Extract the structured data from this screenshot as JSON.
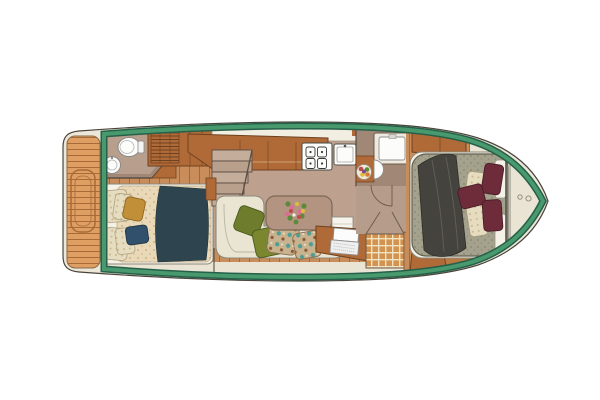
{
  "scene": {
    "subject": "motor-yacht interior floor plan",
    "view": "top-down",
    "rooms": [
      {
        "name": "aft-deck",
        "features": [
          "teak-planking",
          "deck-hatch"
        ]
      },
      {
        "name": "aft-head",
        "features": [
          "toilet",
          "round-sink",
          "corner-counter"
        ]
      },
      {
        "name": "wardrobe",
        "features": [
          "louvered-doors"
        ]
      },
      {
        "name": "aft-cabin",
        "features": [
          "double-bed",
          "cream-duvet",
          "teal-throw",
          "gold-pillow",
          "navy-pillow"
        ]
      },
      {
        "name": "saloon",
        "features": [
          "l-shaped-sofa",
          "olive-pillows",
          "floral-pillows",
          "coffee-table",
          "flower-bouquet",
          "magazine"
        ]
      },
      {
        "name": "galley",
        "features": [
          "counter",
          "cooktop-4-burners",
          "sink"
        ]
      },
      {
        "name": "companionway",
        "features": [
          "stairs"
        ]
      },
      {
        "name": "nav-desk",
        "features": [
          "desk",
          "open-laptop"
        ]
      },
      {
        "name": "forward-head",
        "features": [
          "square-sink",
          "half-round-basin",
          "fruit-bowl",
          "door-swing"
        ]
      },
      {
        "name": "shower",
        "features": [
          "teak-grating"
        ]
      },
      {
        "name": "forward-cabin",
        "features": [
          "island-double-bed",
          "sage-quilt",
          "charcoal-throw",
          "burgundy-pillows",
          "cream-pillows",
          "headboard-shelves"
        ]
      },
      {
        "name": "bow-deck",
        "features": [
          "deck-fittings"
        ]
      }
    ]
  },
  "palette": {
    "bg": "#ffffff",
    "line_dark": "#4a453c",
    "deck_cream": "#ece7d8",
    "interior_cream": "#e9e4d4",
    "green_band": "#49996f",
    "green_band_dark": "#266049",
    "teak_base": "#df9f63",
    "teak_seam": "#a86b38",
    "floor_base": "#c88d5a",
    "floor_seam": "#a2693a",
    "carpet": "#bda08e",
    "wall_taupe": "#a18876",
    "wall_floor": "#b59c8b",
    "wood_cabinet": "#b06a38",
    "wood_dark": "#6e421f",
    "counter_white": "#f2efe2",
    "fixture_white": "#fcfcfa",
    "sofa_cream": "#eae5d3",
    "olive": "#6e7c2d",
    "olive2": "#7a872f",
    "floral_base": "#c9b28e",
    "floral_teal": "#4f9e96",
    "floral_brown": "#8a5a38",
    "table_taupe": "#b29480",
    "duvet_base": "#ead9b9",
    "duvet_dot": "#d3ba8e",
    "pillow_base": "#e6dcc0",
    "pillow_dot": "#c9b690",
    "teal_throw": "#2e4550",
    "gold_pillow": "#c28f39",
    "navy_pillow": "#31506b",
    "sage_base": "#a4a18c",
    "sage_dot": "#8e8b75",
    "charcoal": "#45433d",
    "burgundy": "#6e2c3a",
    "burgundy_dark": "#491c28",
    "grate_base": "#d3924f",
    "grate_line": "#efe3c2",
    "flower_pink": "#dd6d92",
    "flower_yellow": "#e2bb3a",
    "flower_red": "#c04a4a",
    "leaf_green": "#5c8a3a"
  }
}
